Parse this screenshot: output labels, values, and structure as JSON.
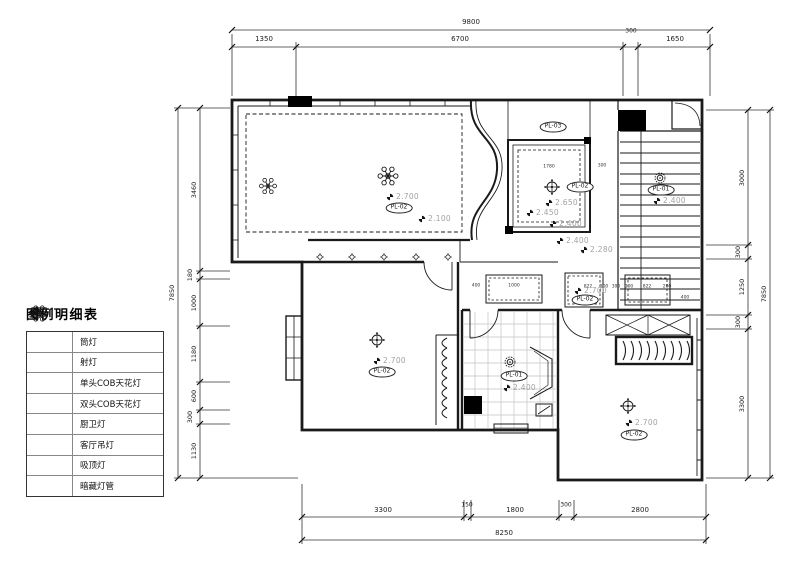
{
  "drawing": {
    "colors": {
      "line": "#1a1a1a",
      "height_label": "#a2a2a2",
      "tile_line": "#c4c4c4"
    },
    "legend": {
      "title": "图例明细表",
      "items": [
        {
          "icon": "downlight-icon",
          "label": "筒灯"
        },
        {
          "icon": "spotlight-icon",
          "label": "射灯"
        },
        {
          "icon": "cob-single-icon",
          "label": "单头COB天花灯"
        },
        {
          "icon": "cob-double-icon",
          "label": "双头COB天花灯"
        },
        {
          "icon": "kitchen-bath-light-icon",
          "label": "厨卫灯"
        },
        {
          "icon": "living-chandelier-icon",
          "label": "客厅吊灯"
        },
        {
          "icon": "ceiling-lamp-icon",
          "label": "吸顶灯"
        },
        {
          "icon": "concealed-tube-icon",
          "label": "暗藏灯管"
        }
      ]
    },
    "dimensions": {
      "top": {
        "overall": "9800",
        "chain": [
          "1350",
          "6700",
          "300",
          "1650"
        ]
      },
      "left": {
        "overall": "7850",
        "chain": [
          "3460",
          "180",
          "1000",
          "1180",
          "600",
          "300",
          "1130"
        ]
      },
      "right": {
        "overall": "7850",
        "chain": [
          "3000",
          "300",
          "1250",
          "300",
          "3300"
        ]
      },
      "bottom": {
        "overall": "8250",
        "chain": [
          "3300",
          "150",
          "1800",
          "300",
          "2800"
        ]
      },
      "inner": {
        "dining_w": "1780",
        "dining_off": "300",
        "hall_1": "400",
        "hall_2": "1000",
        "cove_1": "822",
        "cove_2": "100",
        "cove_3": "390",
        "cove_4": "100",
        "cove_5": "822",
        "cove_6": "200",
        "cove_7": "400"
      }
    },
    "tags": {
      "pl03": "PL-03",
      "pl02_living": "PL-02",
      "pl02_dining": "PL-02",
      "pl01_stairs": "PL-01",
      "pl02_hall": "PL-02",
      "pl02_bedroom1": "PL-02",
      "pl01_bath": "PL-01",
      "pl02_bedroom2": "PL-02"
    },
    "heights": {
      "living": "2.700",
      "living_edge": "2.100",
      "dining_1": "2.650",
      "dining_2": "2.450",
      "dining_3": "2.400",
      "dining_4": "2.400",
      "stairs": "2.400",
      "hall_beam": "2.280",
      "hall": "2.700",
      "bedroom1": "2.700",
      "bath": "2.400",
      "bedroom2": "2.700"
    }
  }
}
